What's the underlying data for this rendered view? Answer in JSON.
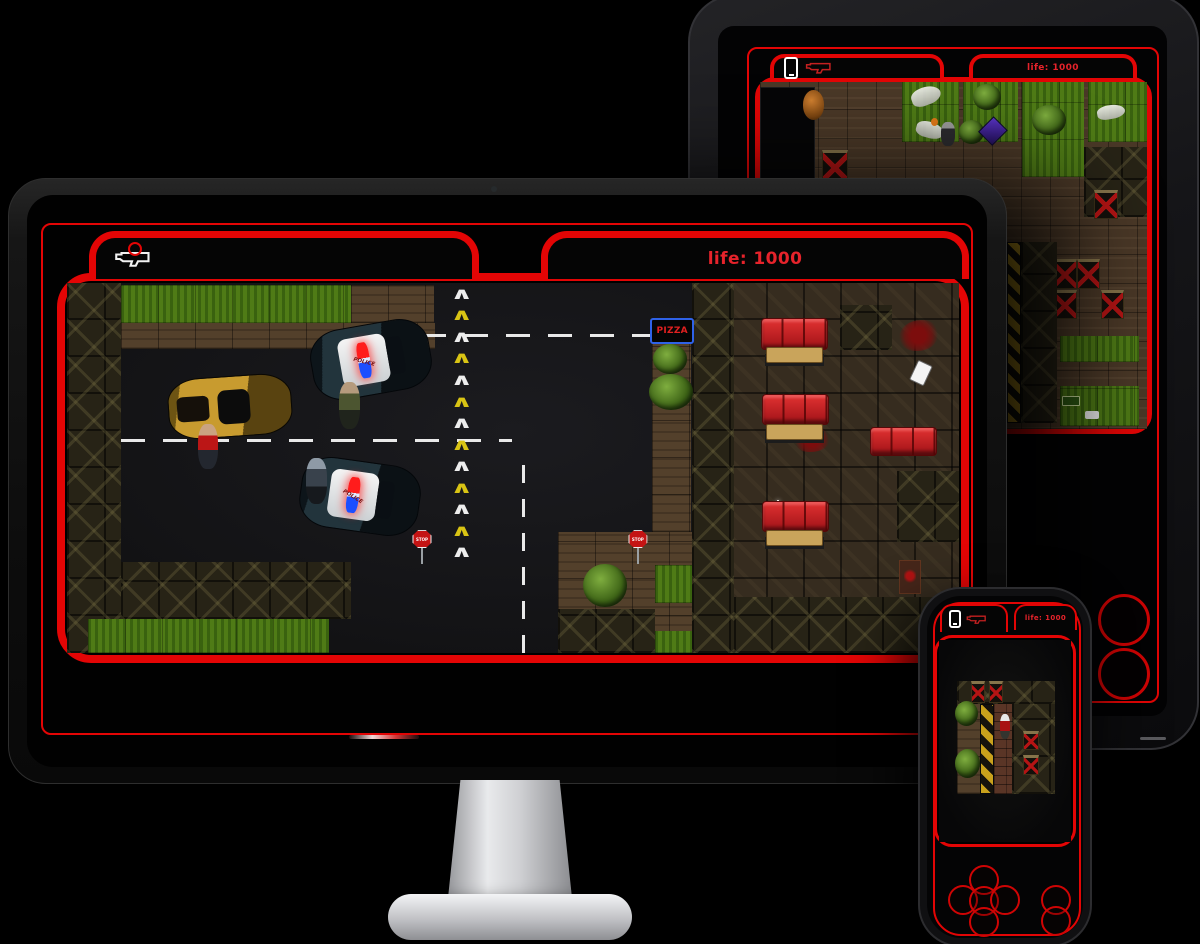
{
  "colors": {
    "frame_red": "#e30505",
    "text_red": "#e6232b",
    "couch_red": "#c81f24",
    "grass_green": "#4f7b16"
  },
  "hud": {
    "life_label": "life: 1000",
    "weapon_icon": "shotgun-icon",
    "phone_icon": "phone-icon"
  },
  "icons": {
    "chevron_glyph": "∧"
  },
  "devices": {
    "monitor": {
      "scene": "street"
    },
    "tablet": {
      "scene": "park",
      "action_buttons": 2
    },
    "phone": {
      "scene": "warehouse",
      "dpad_buttons": [
        "up",
        "left",
        "center",
        "right",
        "down"
      ],
      "action_buttons": [
        "a",
        "b"
      ]
    }
  },
  "scenes": {
    "street": {
      "entities": [
        {
          "t": "crate-col",
          "x": 0,
          "y": 0,
          "w": 6,
          "h": 100
        },
        {
          "t": "grass",
          "x": 6,
          "y": 0.5,
          "w": 25.8,
          "h": 10.2
        },
        {
          "t": "dirt",
          "x": 31.8,
          "y": 0.5,
          "w": 9.4,
          "h": 10.2
        },
        {
          "t": "dirt",
          "x": 6,
          "y": 10.7,
          "w": 35.3,
          "h": 7.2
        },
        {
          "t": "crates",
          "x": 6,
          "y": 75.4,
          "w": 25.8,
          "h": 15.5
        },
        {
          "t": "grass",
          "x": 2.4,
          "y": 90.9,
          "w": 27,
          "h": 9.1
        },
        {
          "t": "dirt",
          "x": 55.1,
          "y": 67.4,
          "w": 15,
          "h": 32.6
        },
        {
          "t": "crates",
          "x": 55.1,
          "y": 88.2,
          "w": 10.8,
          "h": 11.8
        },
        {
          "t": "grass",
          "x": 65.9,
          "y": 76.2,
          "w": 4.2,
          "h": 10.2
        },
        {
          "t": "grass",
          "x": 65.9,
          "y": 94.1,
          "w": 4.2,
          "h": 5.9
        },
        {
          "t": "bush",
          "x": 57.9,
          "y": 75.9,
          "w": 4.9,
          "h": 11.8
        },
        {
          "t": "dirt",
          "x": 65.6,
          "y": 16,
          "w": 4.4,
          "h": 51.3
        },
        {
          "t": "rest-floor",
          "x": 70.1,
          "y": 0,
          "w": 29.9,
          "h": 100
        },
        {
          "t": "crate-col",
          "x": 70.1,
          "y": 0,
          "w": 4.7,
          "h": 100
        },
        {
          "t": "crates",
          "x": 74.8,
          "y": 84.8,
          "w": 25.2,
          "h": 15.2
        },
        {
          "t": "crates",
          "x": 86.7,
          "y": 5.9,
          "w": 5.8,
          "h": 12.3
        },
        {
          "t": "crates",
          "x": 93.1,
          "y": 50.8,
          "w": 6.9,
          "h": 19.3
        },
        {
          "t": "dash-h",
          "x": 35.1,
          "y": 13.9,
          "w": 30.5
        },
        {
          "t": "dash-h",
          "x": 6,
          "y": 42.2,
          "w": 43.9
        },
        {
          "t": "dash-v",
          "x": 51,
          "y": 47.3,
          "h": 52.7
        },
        {
          "t": "chevrons",
          "x": 42.9,
          "y": 0.5,
          "w": 2.6,
          "h": 75,
          "count": 13
        },
        {
          "t": "pizza-sign",
          "x": 65.4,
          "y": 9.4,
          "w": 4.9,
          "h": 7,
          "label": "PIZZA"
        },
        {
          "t": "bush",
          "x": 65.7,
          "y": 16.6,
          "w": 3.8,
          "h": 8
        },
        {
          "t": "bush",
          "x": 65.3,
          "y": 24.6,
          "w": 4.9,
          "h": 9.6
        },
        {
          "t": "police-car",
          "x": 27.4,
          "y": 11.2,
          "w": 13.5,
          "h": 19.3,
          "r": -10,
          "label": "POLICE"
        },
        {
          "t": "police-car",
          "x": 26.1,
          "y": 48.1,
          "w": 13.5,
          "h": 19.3,
          "r": 8,
          "label": "POLICE"
        },
        {
          "t": "gold-car",
          "x": 11.3,
          "y": 25.1,
          "w": 13.9,
          "h": 16.6,
          "r": -4
        },
        {
          "t": "ped-red",
          "x": 14.7,
          "y": 38,
          "w": 2.2,
          "h": 12.3
        },
        {
          "t": "ped-olive",
          "x": 30.5,
          "y": 26.7,
          "w": 2.4,
          "h": 12.8
        },
        {
          "t": "ped-swat",
          "x": 26.8,
          "y": 47.3,
          "w": 2.4,
          "h": 12.3
        },
        {
          "t": "stop-sign",
          "x": 38.7,
          "y": 66.8,
          "w": 2.2,
          "h": 9.1,
          "label": "STOP"
        },
        {
          "t": "stop-sign",
          "x": 62.9,
          "y": 66.8,
          "w": 2.2,
          "h": 9.1,
          "label": "STOP"
        },
        {
          "t": "couch",
          "x": 77.8,
          "y": 9.4,
          "w": 7.5,
          "h": 8.6
        },
        {
          "t": "table",
          "x": 78.4,
          "y": 17.4,
          "w": 6.4,
          "h": 4.3
        },
        {
          "t": "couch",
          "x": 77.9,
          "y": 29.9,
          "w": 7.5,
          "h": 8.6
        },
        {
          "t": "table",
          "x": 78.4,
          "y": 38,
          "w": 6.4,
          "h": 4.3
        },
        {
          "t": "couch",
          "x": 77.9,
          "y": 58.8,
          "w": 7.5,
          "h": 8.6
        },
        {
          "t": "table",
          "x": 78.4,
          "y": 66.8,
          "w": 6.4,
          "h": 4.3
        },
        {
          "t": "couch",
          "x": 90,
          "y": 38.8,
          "w": 7.5,
          "h": 8
        },
        {
          "t": "blood",
          "x": 93.3,
          "y": 9.9,
          "w": 4.4,
          "h": 8.6
        },
        {
          "t": "blood",
          "x": 81.5,
          "y": 39.3,
          "w": 4,
          "h": 6.4
        },
        {
          "t": "phone-item",
          "x": 94.8,
          "y": 21.4,
          "w": 1.8,
          "h": 5.9,
          "r": 25
        },
        {
          "t": "sparkle",
          "x": 78.7,
          "y": 58.8,
          "w": 2,
          "h": 4.8
        },
        {
          "t": "door",
          "x": 93.3,
          "y": 74.9,
          "w": 2.4,
          "h": 9.1
        }
      ]
    },
    "park": {
      "entities": [
        {
          "t": "garage",
          "x": 0,
          "y": 1.4,
          "w": 14.1,
          "h": 27.3
        },
        {
          "t": "barrel",
          "x": 11,
          "y": 2.3,
          "w": 5.6,
          "h": 8.6
        },
        {
          "t": "redx",
          "x": 16.1,
          "y": 19.5,
          "w": 6.6,
          "h": 9.8
        },
        {
          "t": "redx",
          "x": 18.2,
          "y": 32.5,
          "w": 6.6,
          "h": 9.8
        },
        {
          "t": "grass",
          "x": 36.6,
          "y": 0,
          "w": 14.8,
          "h": 17.2
        },
        {
          "t": "grass",
          "x": 52.4,
          "y": 0,
          "w": 14.3,
          "h": 17.2
        },
        {
          "t": "grass",
          "x": 67.8,
          "y": 0,
          "w": 15.9,
          "h": 27.3
        },
        {
          "t": "grass",
          "x": 84.7,
          "y": 0,
          "w": 15.3,
          "h": 17.2
        },
        {
          "t": "corpse",
          "x": 39.1,
          "y": 1.4,
          "w": 7.7,
          "h": 5.2,
          "r": -20
        },
        {
          "t": "corpse",
          "x": 40.4,
          "y": 11.5,
          "w": 7.2,
          "h": 4.6,
          "r": 15
        },
        {
          "t": "corpse",
          "x": 87.2,
          "y": 6.6,
          "w": 7.2,
          "h": 4,
          "r": -10
        },
        {
          "t": "bush",
          "x": 55,
          "y": 0.6,
          "w": 7.2,
          "h": 7.5
        },
        {
          "t": "bush",
          "x": 51.4,
          "y": 10.9,
          "w": 6.6,
          "h": 6.9
        },
        {
          "t": "bush",
          "x": 70.3,
          "y": 6.6,
          "w": 8.7,
          "h": 8.6
        },
        {
          "t": "gem",
          "x": 57.5,
          "y": 10.9,
          "w": 5.1,
          "h": 6.3
        },
        {
          "t": "orange-dot",
          "x": 44.2,
          "y": 10.3,
          "w": 1.8,
          "h": 2.3
        },
        {
          "t": "player",
          "x": 46.8,
          "y": 11.5,
          "w": 3.6,
          "h": 6.9
        },
        {
          "t": "crates",
          "x": 83.6,
          "y": 18.7,
          "w": 16.4,
          "h": 20.1
        },
        {
          "t": "redx",
          "x": 86.4,
          "y": 31,
          "w": 6.1,
          "h": 8.6
        },
        {
          "t": "redx",
          "x": 75.7,
          "y": 51.1,
          "w": 6.1,
          "h": 8.6
        },
        {
          "t": "redx",
          "x": 81.8,
          "y": 51.1,
          "w": 6.1,
          "h": 8.6
        },
        {
          "t": "redx",
          "x": 75.7,
          "y": 59.8,
          "w": 6.1,
          "h": 8.6
        },
        {
          "t": "redx",
          "x": 88,
          "y": 59.8,
          "w": 6.1,
          "h": 8.6
        },
        {
          "t": "hazard",
          "x": 63.9,
          "y": 46,
          "w": 3.6,
          "h": 52.3
        },
        {
          "t": "crate-col",
          "x": 67.5,
          "y": 46,
          "w": 9.2,
          "h": 52.3
        },
        {
          "t": "grass",
          "x": 77.5,
          "y": 73.3,
          "w": 20.5,
          "h": 7.5
        },
        {
          "t": "grass",
          "x": 77.5,
          "y": 87.6,
          "w": 20.5,
          "h": 11.5
        },
        {
          "t": "sign-green",
          "x": 78,
          "y": 90.5,
          "w": 4.6,
          "h": 2.9
        },
        {
          "t": "white-item",
          "x": 83.9,
          "y": 94.8,
          "w": 3.6,
          "h": 2.3
        }
      ]
    },
    "warehouse": {
      "entities": [
        {
          "t": "crates",
          "x": 13.5,
          "y": 20.5,
          "w": 74.3,
          "h": 11.4
        },
        {
          "t": "redx",
          "x": 24.3,
          "y": 20.5,
          "w": 10.8,
          "h": 10.5
        },
        {
          "t": "redx",
          "x": 37.8,
          "y": 20.5,
          "w": 10.8,
          "h": 10.5
        },
        {
          "t": "dirt",
          "x": 13.5,
          "y": 31.9,
          "w": 17.6,
          "h": 44.3
        },
        {
          "t": "bush",
          "x": 12.2,
          "y": 30,
          "w": 17.6,
          "h": 12.4
        },
        {
          "t": "bush",
          "x": 12.2,
          "y": 53.8,
          "w": 18.9,
          "h": 14.3
        },
        {
          "t": "hazard",
          "x": 31.1,
          "y": 31.9,
          "w": 10.8,
          "h": 44.3
        },
        {
          "t": "brick",
          "x": 41.9,
          "y": 31.9,
          "w": 13.5,
          "h": 44.3
        },
        {
          "t": "crates",
          "x": 55.4,
          "y": 31.9,
          "w": 32.4,
          "h": 44.3
        },
        {
          "t": "redx",
          "x": 63.5,
          "y": 45.2,
          "w": 12.2,
          "h": 9.5
        },
        {
          "t": "redx",
          "x": 63.5,
          "y": 57.1,
          "w": 12.2,
          "h": 9.5
        },
        {
          "t": "player-red",
          "x": 45.9,
          "y": 36.7,
          "w": 8.1,
          "h": 12.4
        }
      ]
    }
  }
}
